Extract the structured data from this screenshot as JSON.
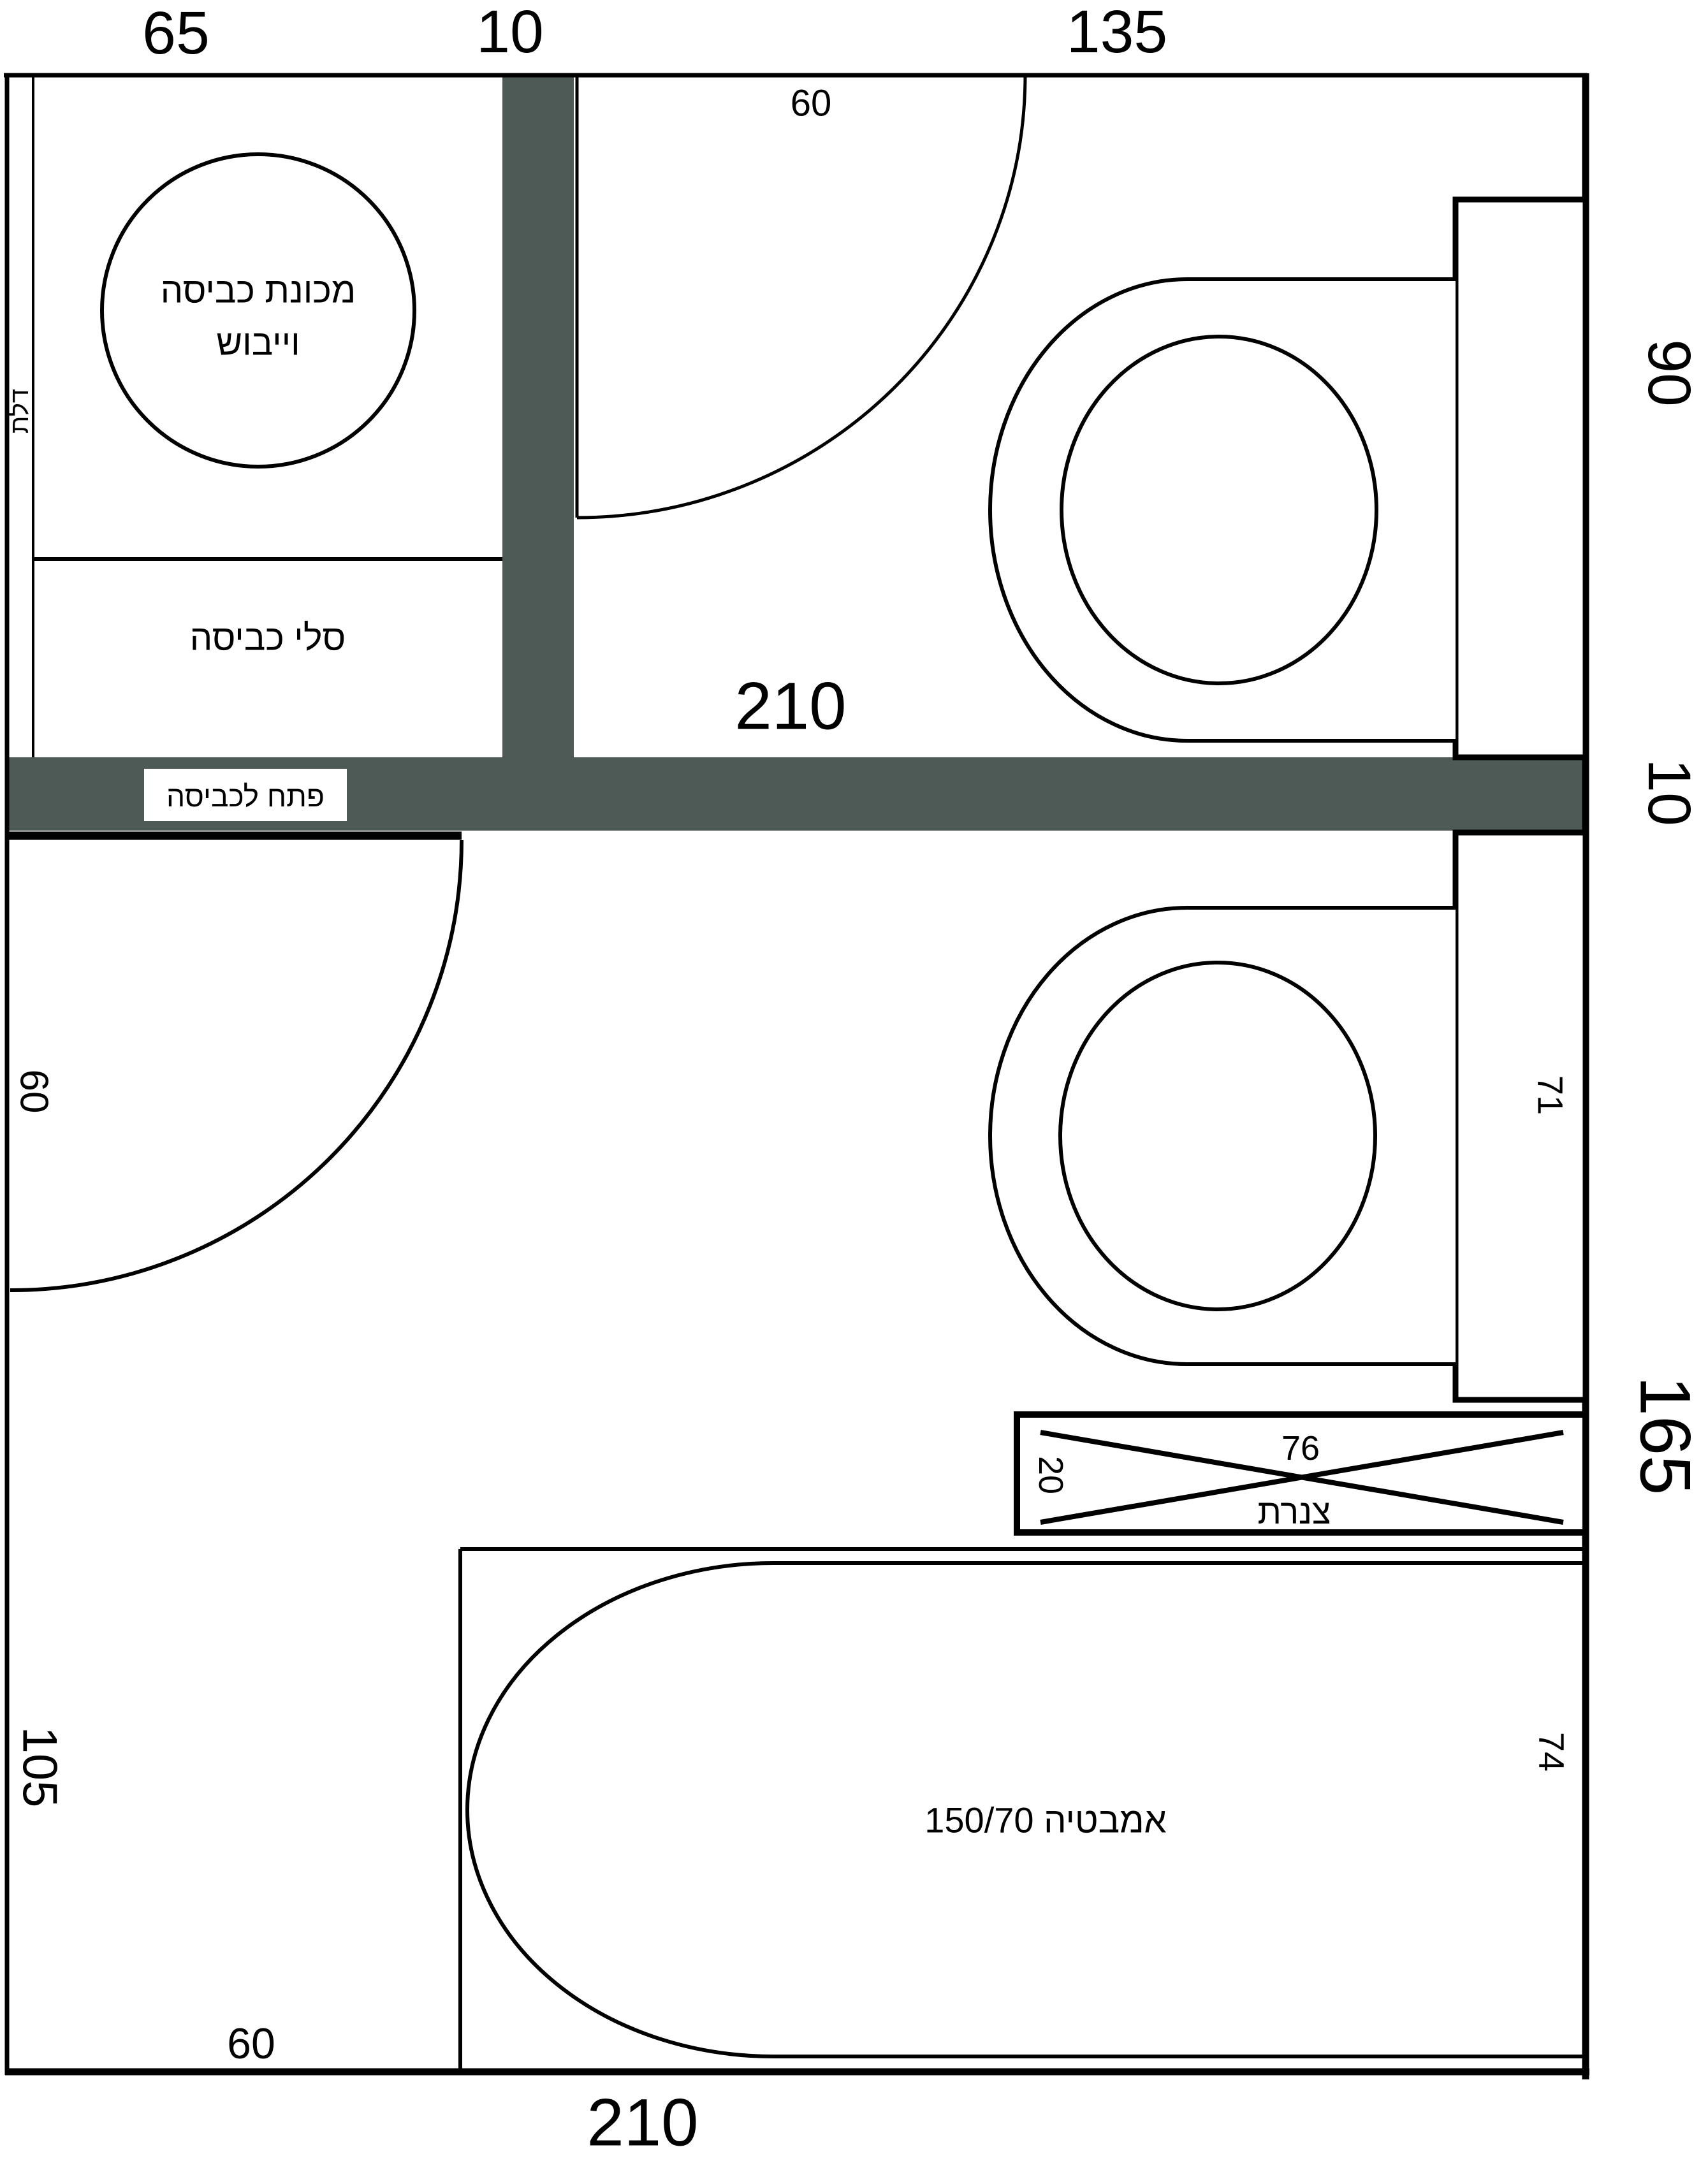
{
  "colors": {
    "background": "#ffffff",
    "wall_fill": "#4d5a55",
    "line": "#000000"
  },
  "dims": {
    "top_left_room_width": "65",
    "top_partition_thickness": "10",
    "top_right_room_width": "135",
    "right_upper_room_height": "90",
    "right_wall_thickness": "10",
    "right_lower_room_height": "165",
    "upper_room_inner_width": "210",
    "upper_door_width": "60",
    "niche_height": "71",
    "pipes_width": "76",
    "pipes_depth": "20",
    "bath_width": "74",
    "lower_door_width": "60",
    "left_lower_wall": "105",
    "bath_left_offset": "60",
    "bottom_total_width": "210"
  },
  "labels": {
    "washer_line1": "מכונת כביסה",
    "washer_line2": "וייבוש",
    "laundry_baskets": "סלי כביסה",
    "door_strip": "דלת",
    "laundry_hatch": "פתח לכביסה",
    "pipes": "צנרת",
    "bathtub": "אמבטיה 150/70"
  }
}
